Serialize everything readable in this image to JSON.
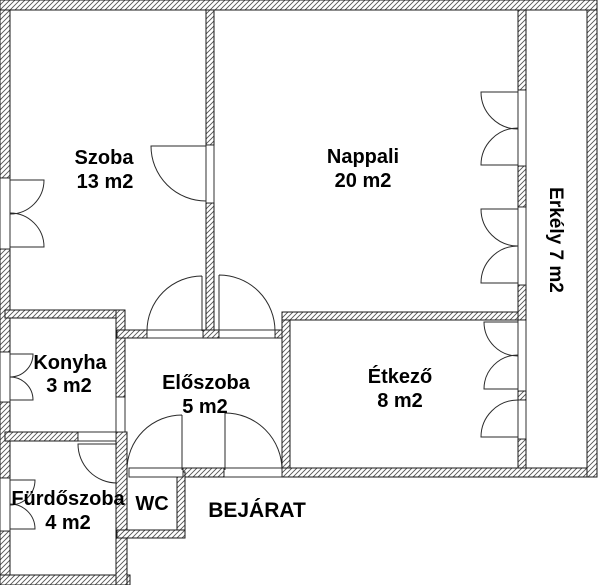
{
  "floorplan": {
    "title": "Apartment floor plan",
    "rooms": {
      "szoba": {
        "name": "Szoba",
        "area": "13 m2"
      },
      "nappali": {
        "name": "Nappali",
        "area": "20 m2"
      },
      "erkely": {
        "label": "Erkély 7 m2"
      },
      "konyha": {
        "name": "Konyha",
        "area": "3 m2"
      },
      "eloszoba": {
        "name": "Előszoba",
        "area": "5 m2"
      },
      "etkezo": {
        "name": "Étkező",
        "area": "8 m2"
      },
      "furdoszoba": {
        "name": "Fürdőszoba",
        "area": "4 m2"
      },
      "wc": {
        "name": "WC"
      }
    },
    "entrance_label": "BEJÁRAT",
    "colors": {
      "background": "#ffffff",
      "wall_outline": "#1a1a1a",
      "hatch_line": "#555555",
      "text": "#000000"
    }
  }
}
